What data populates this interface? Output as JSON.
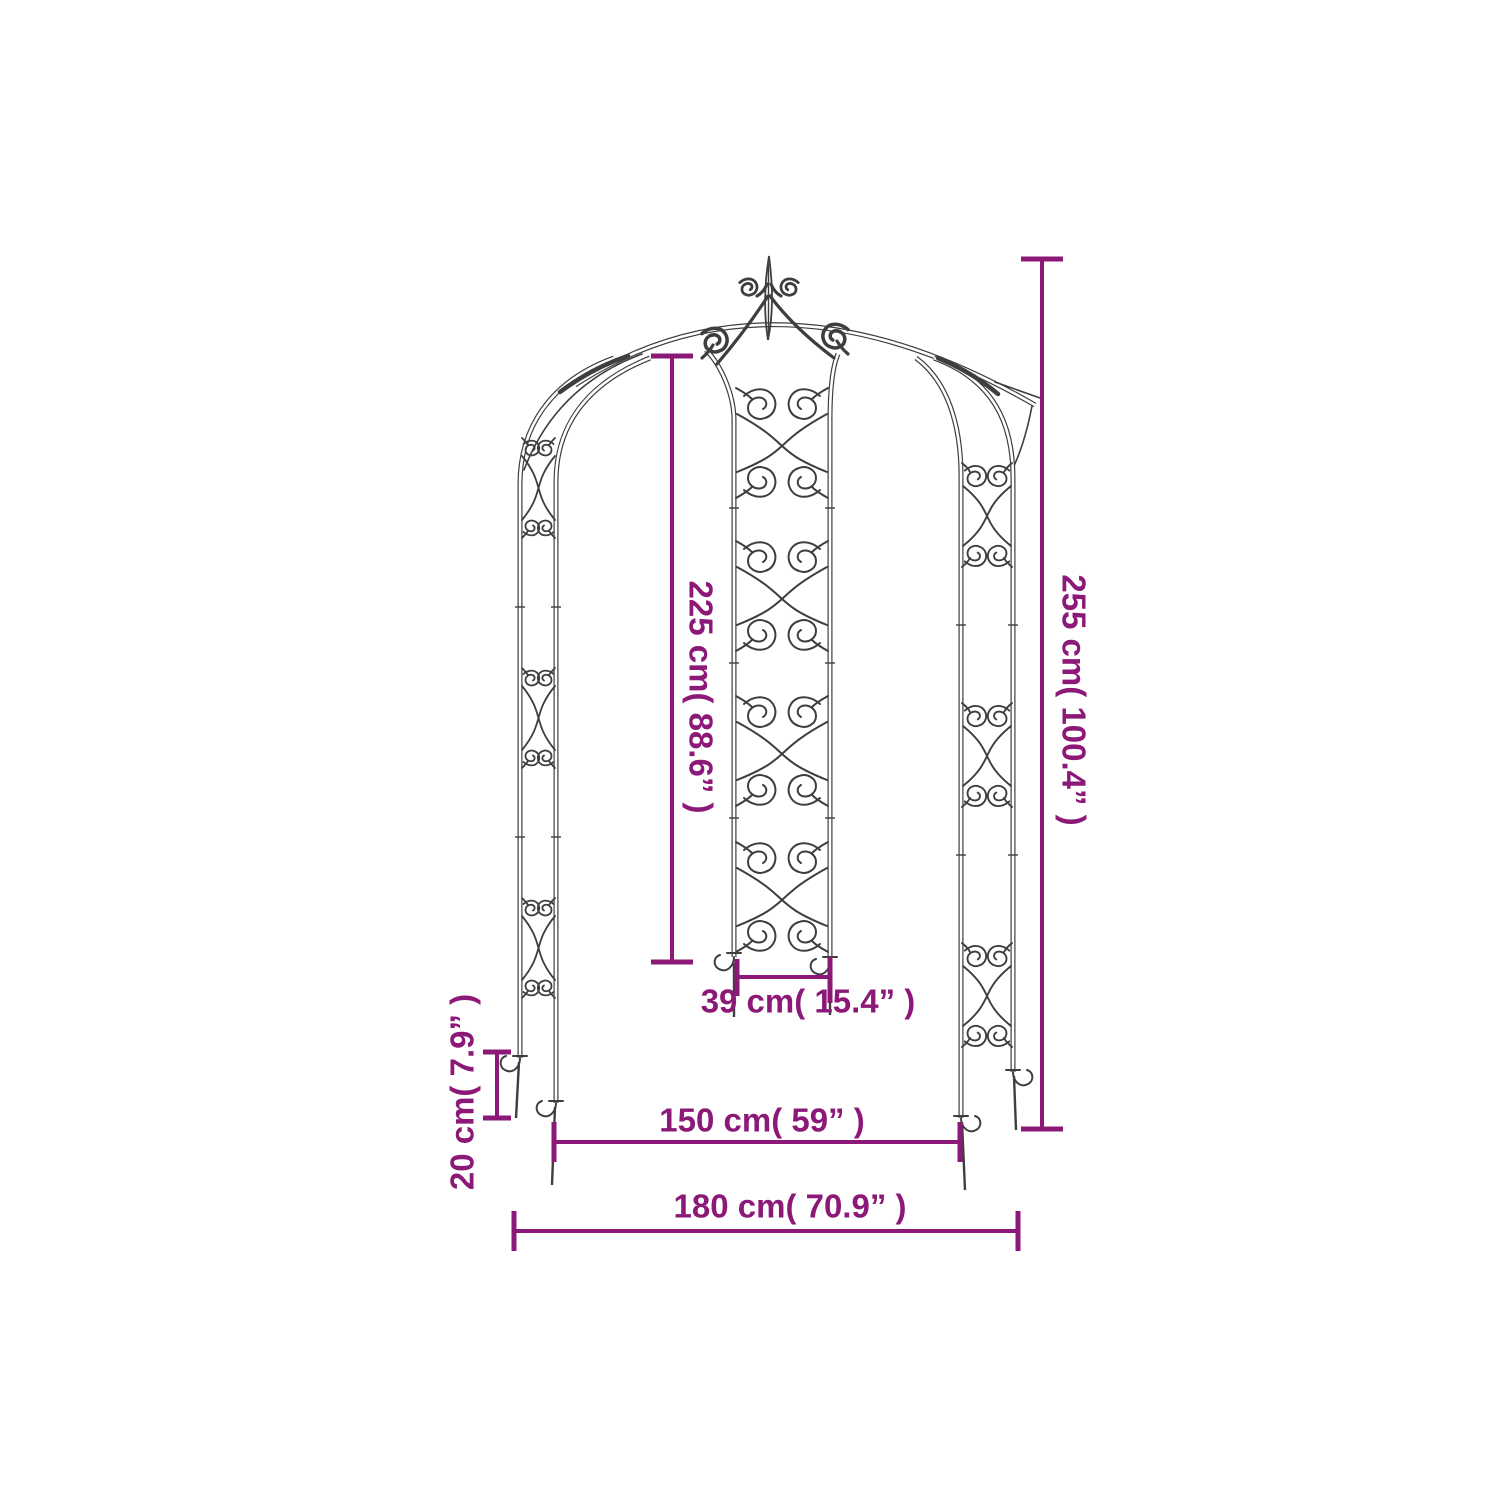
{
  "diagram": {
    "background_color": "#ffffff",
    "drawing_line_color": "#3e3e3e",
    "dimension_color": "#8c1878",
    "labels": {
      "inner_height": "225 cm( 88.6” )",
      "total_height": "255 cm( 100.4” )",
      "panel_width": "39 cm( 15.4” )",
      "ground_stake_length": "20 cm( 7.9” )",
      "inner_width": "150 cm( 59” )",
      "total_width": "180 cm( 70.9” )"
    }
  }
}
